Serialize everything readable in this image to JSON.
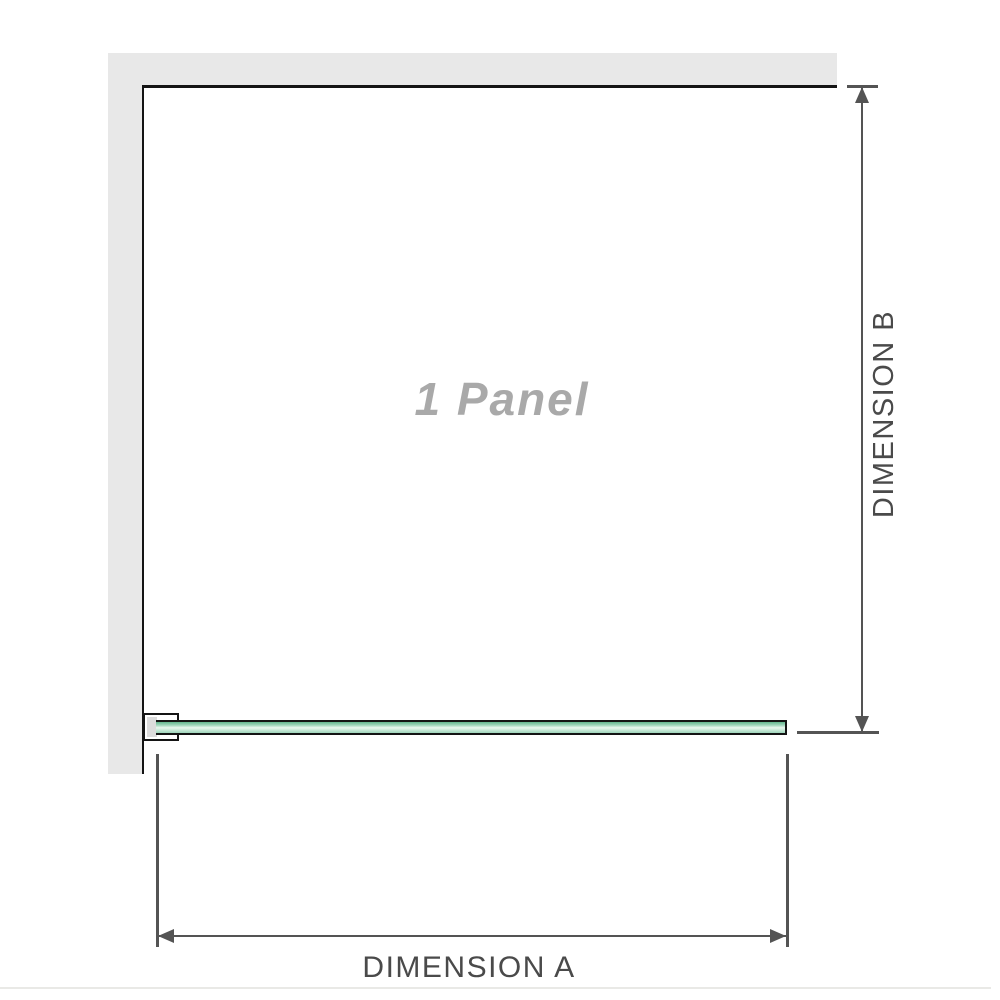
{
  "diagram": {
    "panel_label": "1 Panel",
    "dimension_a_label": "DIMENSION A",
    "dimension_b_label": "DIMENSION B",
    "colors": {
      "wall": "#e8e8e8",
      "outline": "#141414",
      "dimension_lines": "#545454",
      "dimension_text": "#4a4a4a",
      "panel_label_text": "#a9a9a9",
      "glass_edge_green": "#63b68e",
      "glass_mid_green": "#9ed5ba",
      "glass_light_green": "#e9f7ef",
      "separator": "#e9e9e6"
    }
  }
}
